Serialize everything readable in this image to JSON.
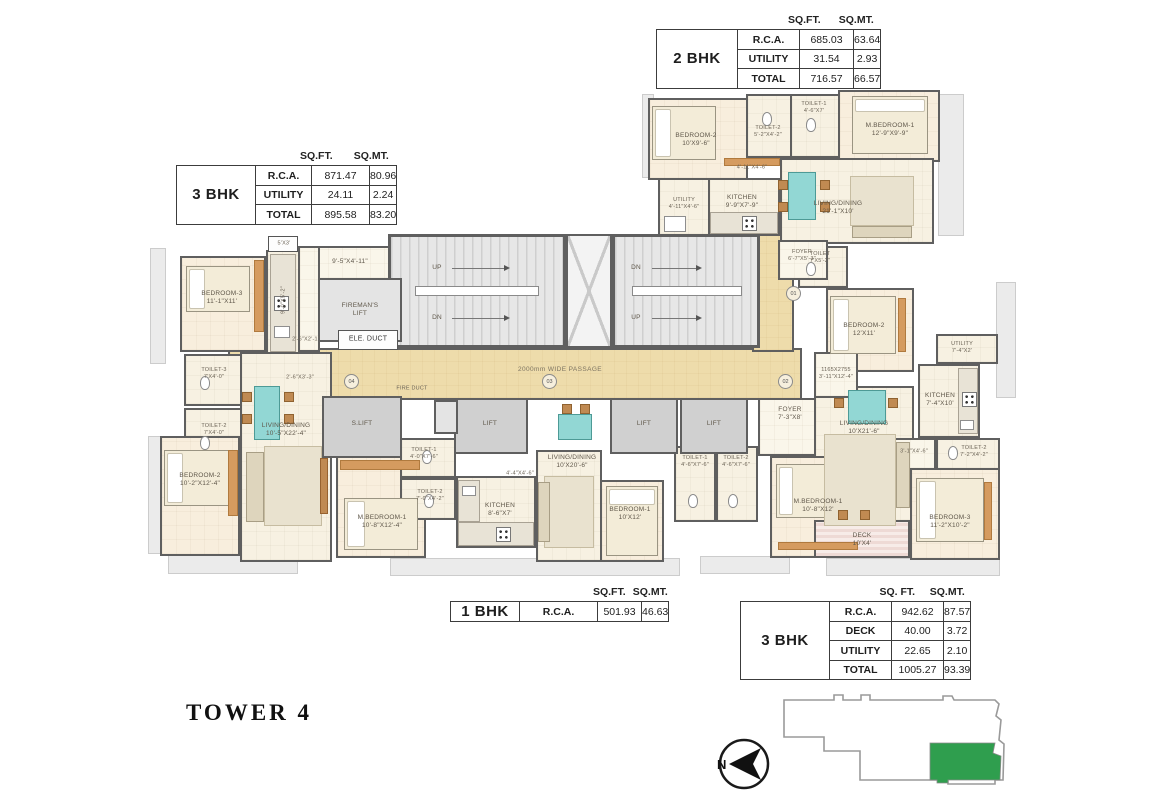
{
  "title": {
    "text": "TOWER 4"
  },
  "compass": {
    "label": "N"
  },
  "colors": {
    "wall": "#5f5f5f",
    "floor": "#f7f1e2",
    "passage": "#eedcab",
    "core_gray": "#e4e4e4",
    "lift_gray": "#d0d0d0",
    "wood_accent": "#d59b5f",
    "dining_teal": "#92d7d4",
    "deck_pink": "#eedad5",
    "keyplan_green": "#2f9e4e"
  },
  "tables": {
    "bhk2": {
      "name": "2 BHK",
      "col_sqft": "SQ.FT.",
      "col_sqmt": "SQ.MT.",
      "rows": [
        {
          "label": "R.C.A.",
          "sqft": "685.03",
          "sqmt": "63.64"
        },
        {
          "label": "UTILITY",
          "sqft": "31.54",
          "sqmt": "2.93"
        },
        {
          "label": "TOTAL",
          "sqft": "716.57",
          "sqmt": "66.57"
        }
      ]
    },
    "bhk3_left": {
      "name": "3 BHK",
      "col_sqft": "SQ.FT.",
      "col_sqmt": "SQ.MT.",
      "rows": [
        {
          "label": "R.C.A.",
          "sqft": "871.47",
          "sqmt": "80.96"
        },
        {
          "label": "UTILITY",
          "sqft": "24.11",
          "sqmt": "2.24"
        },
        {
          "label": "TOTAL",
          "sqft": "895.58",
          "sqmt": "83.20"
        }
      ]
    },
    "bhk1": {
      "name": "1 BHK",
      "col_sqft": "SQ.FT.",
      "col_sqmt": "SQ.MT.",
      "rows": [
        {
          "label": "R.C.A.",
          "sqft": "501.93",
          "sqmt": "46.63"
        }
      ]
    },
    "bhk3_right": {
      "name": "3 BHK",
      "col_sqft": "SQ. FT.",
      "col_sqmt": "SQ.MT.",
      "rows": [
        {
          "label": "R.C.A.",
          "sqft": "942.62",
          "sqmt": "87.57"
        },
        {
          "label": "DECK",
          "sqft": "40.00",
          "sqmt": "3.72"
        },
        {
          "label": "UTILITY",
          "sqft": "22.65",
          "sqmt": "2.10"
        },
        {
          "label": "TOTAL",
          "sqft": "1005.27",
          "sqmt": "93.39"
        }
      ]
    }
  },
  "plan": {
    "core": {
      "stair_dims": "9'-5\"X4'-11\"",
      "fireman_lift": "FIREMAN'S\nLIFT",
      "ele_duct": "ELE. DUCT",
      "up": "UP",
      "dn": "DN",
      "passage": "2000mm WIDE PASSAGE",
      "fire_duct": "FIRE DUCT",
      "s_lift": "S.LIFT",
      "lift": "LIFT",
      "unit_01": "01",
      "unit_02": "02",
      "unit_03": "03",
      "unit_04": "04"
    },
    "unit04": {
      "bedroom3": "BEDROOM-3\n11'-1\"X11'",
      "kitchen_dims": "9'-0\"X5'-2\"",
      "duct": "5'X3'",
      "toilet3": "TOILET-3\n7'X4'-0\"",
      "toilet2": "TOILET-2\n7'X4'-0\"",
      "pass1": "2'-6\"X2'-1\"",
      "pass2": "2'-6\"X3'-3\"",
      "living": "LIVING/DINING\n10'-5\"X22'-4\"",
      "bedroom2": "BEDROOM-2\n10'-2\"X12'-4\"",
      "mbedroom": "M.BEDROOM-1\n10'-8\"X12'-4\""
    },
    "unit03": {
      "toilet1": "TOILET-1\n4'-0\"X7'-6\"",
      "toilet2": "TOILET-2\n7'-0\"X4'-2\"",
      "kitchen": "KITCHEN\n8'-6\"X7'",
      "foyer_dims": "4'-4\"X4'-6\"",
      "living": "LIVING/DINING\n10'X20'-6\"",
      "bedroom1": "BEDROOM-1\n10'X12'"
    },
    "unit02": {
      "toilet1": "TOILET-1\n4'-6\"X7'-6\"",
      "toilet2": "TOILET-2\n4'-6\"X7'-6\"",
      "foyer": "FOYER\n7'-3\"X8'",
      "living": "LIVING/DINING\n10'X21'-6\"",
      "mbedroom": "M.BEDROOM-1\n10'-8\"X12'",
      "deck": "DECK\n10'X4'",
      "bedroom3": "BEDROOM-3\n11'-2\"X10'-2\"",
      "toilet3": "TOILET-2\n7'-2\"X4'-2\"",
      "pass": "3'-1\"X4'-6\"",
      "niche": "1165X2755\n3'-11\"X12'-4\"",
      "bedroom2": "BEDROOM-2\n12'X11'",
      "kitchen": "KITCHEN\n7'-4\"X10'",
      "utility": "UTILITY\n7'-4\"X2'",
      "toilet_top": "TOILET\n7'X5'-2\""
    },
    "unit01": {
      "bedroom2": "BEDROOM-2\n10'X9'-6\"",
      "toilet1": "TOILET-1\n4'-6\"X7'",
      "toilet2": "TOILET-2\n5'-2\"X4'-2\"",
      "mbedroom": "M.BEDROOM-1\n12'-9\"X9'-9\"",
      "hall_dims": "4'-11\"X4'-6\"",
      "utility": "UTILITY\n4'-11\"X4'-6\"",
      "kitchen": "KITCHEN\n9'-9\"X7'-9\"",
      "living": "LIVING/DINING\n21'-1\"X10'",
      "foyer": "FOYER\n6'-7\"X5'-3\""
    }
  }
}
